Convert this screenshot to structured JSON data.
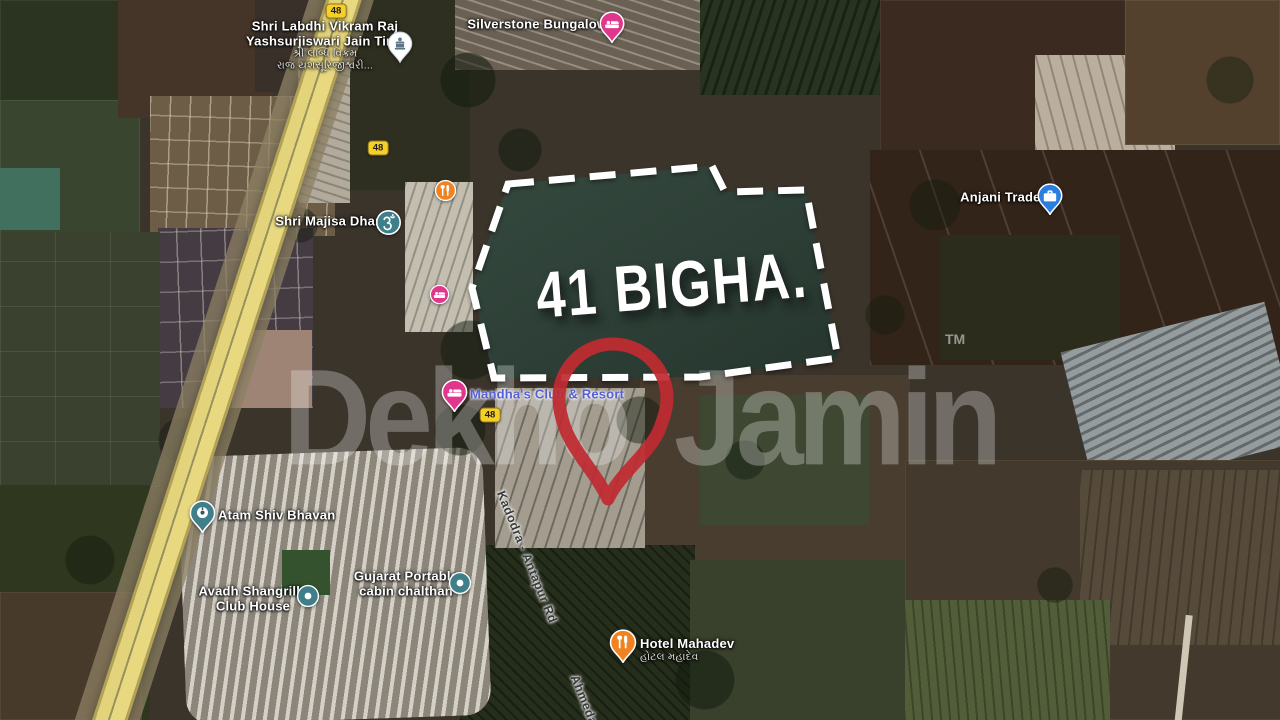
{
  "plot": {
    "area_label": "41 BIGHA.",
    "outline_color": "#ffffff",
    "fill_color": "#2d4038"
  },
  "watermark": {
    "word1": "Dekho",
    "word2": "Jamin",
    "tm": "TM",
    "pin_color": "#bf2b31"
  },
  "roads": {
    "shield": "48",
    "kadodra_label": "Kadodra - Antapur Rd",
    "ahmedabad_label": "Ahmeda",
    "highway_color": "#e3d37b"
  },
  "pois": {
    "jain_tirth": {
      "line1": "Shri Labdhi Vikram Raj",
      "line2": "Yashsurjiswari Jain Tirth",
      "sub1": "શ્રી લબ્ધિ વિક્રમ",
      "sub2": "રાજ યશસૂરિજીશ્વરી...",
      "icon": "temple-icon",
      "icon_color": "#ffffff"
    },
    "silverstone": {
      "name": "Silverstone Bungalows",
      "icon": "lodging-icon",
      "icon_color": "#e0368c"
    },
    "majisa": {
      "name": "Shri Majisa Dham",
      "icon": "om-icon",
      "icon_color": "#3e7f8a"
    },
    "anjani": {
      "name": "Anjani Trader",
      "icon": "briefcase-icon",
      "icon_color": "#2a7de1"
    },
    "mandha": {
      "name": "Mandha's Club & Resort",
      "icon": "lodging-icon",
      "icon_color": "#e0368c",
      "label_color": "#5560d4"
    },
    "atam": {
      "name": "Atam Shiv Bhavan",
      "icon": "temple-icon",
      "icon_color": "#3e7f8a"
    },
    "avadh": {
      "line1": "Avadh Shangrilla",
      "line2": "Club House",
      "icon": "poi-dot-icon",
      "icon_color": "#3e7f8a"
    },
    "gujarat_portable": {
      "line1": "Gujarat Portable",
      "line2": "cabin chalthan",
      "icon": "poi-dot-icon",
      "icon_color": "#3e7f8a"
    },
    "hotel_mahadev": {
      "name": "Hotel Mahadev",
      "sub": "હોટલ મહાદેવ",
      "icon": "restaurant-icon",
      "icon_color": "#ef8322"
    },
    "restaurant_unlabeled": {
      "icon": "restaurant-icon",
      "icon_color": "#ef8322"
    },
    "lodging_unlabeled": {
      "icon": "lodging-icon",
      "icon_color": "#e0368c"
    }
  }
}
